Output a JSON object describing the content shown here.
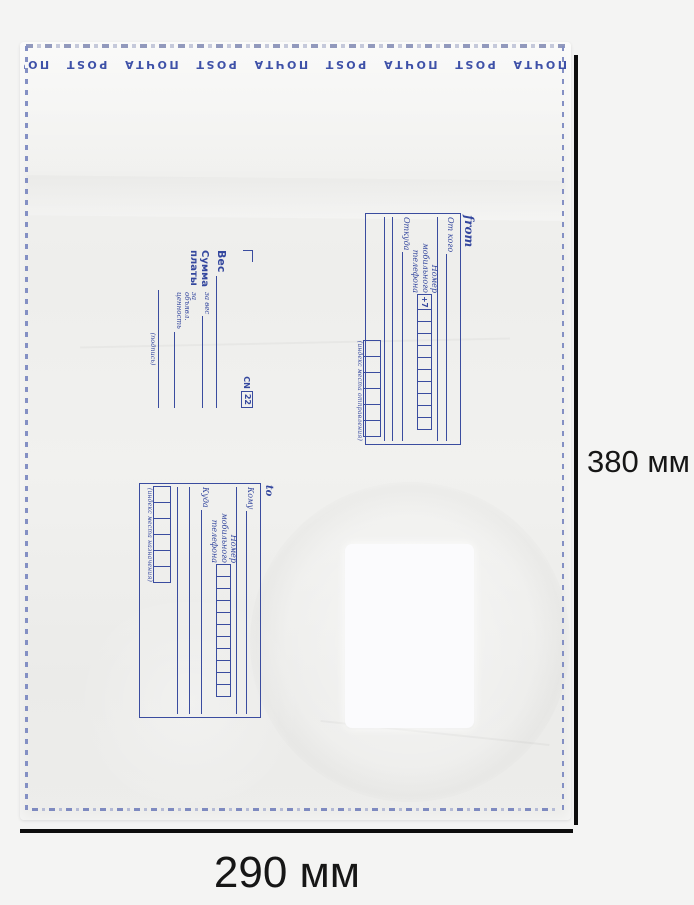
{
  "dimensions": {
    "height_label": "380 мм",
    "width_label": "290 мм"
  },
  "colors": {
    "print_blue": "#34479e",
    "stitch_blue": "#8490c4",
    "dimension_black": "#0d0d0d",
    "background_gray": "#f4f4f3",
    "envelope_white": "#efefed",
    "label_white": "#fbfbfd"
  },
  "envelope": {
    "brand_strip": {
      "text": "ПОЧТА POST",
      "repeat": 16
    },
    "from_block": {
      "title": "from",
      "from_label": "От кого",
      "phone_label": "Номер мобильного телефона",
      "phone_prefix": "+7",
      "phone_cells": 10,
      "origin_label": "Откуда",
      "index_cells": 6,
      "index_caption": "(индекс места отправления)"
    },
    "payment_block": {
      "weight_label": "Вес",
      "sum_label": "Сумма платы",
      "per_weight_label": "за вес",
      "per_value_label": "за объявл. ценность",
      "signature_label": "(подпись)",
      "cn_label": "CN",
      "cn_number": "22"
    },
    "to_block": {
      "title": "to",
      "to_label": "Кому",
      "phone_label": "Номер мобильного телефона",
      "phone_cells": 11,
      "destination_label": "Куда",
      "index_cells": 6,
      "index_caption": "(индекс места назначения)"
    }
  }
}
